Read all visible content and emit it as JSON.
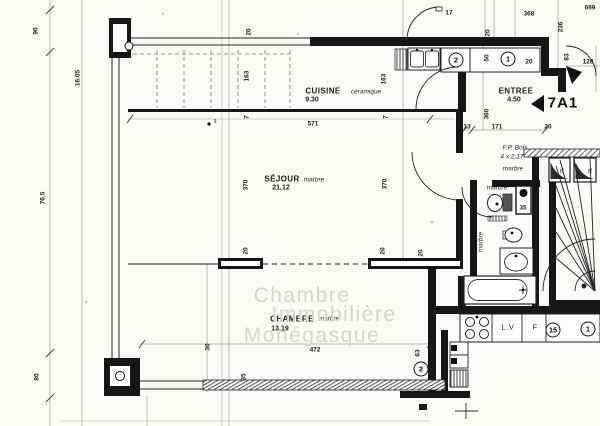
{
  "unit": {
    "label": "7A1"
  },
  "rooms": [
    {
      "name": "CUISINE",
      "area": "9.30",
      "finish": "céramique"
    },
    {
      "name": "ENTREE",
      "area": "4.50",
      "finish": ""
    },
    {
      "name": "SÉJOUR",
      "area": "21.12",
      "finish": "marbre"
    },
    {
      "name": "CHAMBRE",
      "area": "13.19",
      "finish": "marbre"
    },
    {
      "name": "F.P. Bois",
      "area": "4 x 2,17",
      "finish": "marbre"
    }
  ],
  "watermark": [
    "Chambre",
    "Immobilière",
    "Monégasque"
  ],
  "appliances": {
    "dishwasher": "L.V",
    "fridge": "F"
  },
  "colors": {
    "ink": "#1c1c1c",
    "paper": "#fafaf7",
    "watermark": "#d6d6d1"
  },
  "texts": [
    {
      "t": "CUISINE",
      "x": 323,
      "y": 91,
      "cls": "room"
    },
    {
      "t": "9.30",
      "x": 312,
      "y": 100,
      "cls": "area"
    },
    {
      "t": "céramique",
      "x": 366,
      "y": 92,
      "cls": "script"
    },
    {
      "t": "ENTREE",
      "x": 516,
      "y": 91,
      "cls": "room"
    },
    {
      "t": "4.50",
      "x": 514,
      "y": 100,
      "cls": "area"
    },
    {
      "t": "SÉJOUR",
      "x": 282,
      "y": 179,
      "cls": "room"
    },
    {
      "t": "21.12",
      "x": 281,
      "y": 188,
      "cls": "area"
    },
    {
      "t": "marbre",
      "x": 314,
      "y": 180,
      "cls": "script"
    },
    {
      "t": "CHAMBRE",
      "x": 292,
      "y": 319,
      "cls": "room"
    },
    {
      "t": "13.19",
      "x": 280,
      "y": 329,
      "cls": "area"
    },
    {
      "t": "marbre",
      "x": 329,
      "y": 319,
      "cls": "script"
    },
    {
      "t": "F.P. Bois",
      "x": 515,
      "y": 148,
      "cls": "script"
    },
    {
      "t": "4 x 2,17",
      "x": 512,
      "y": 157,
      "cls": "script"
    },
    {
      "t": "marbre",
      "x": 513,
      "y": 169,
      "cls": "script"
    },
    {
      "t": "marbre",
      "x": 497,
      "y": 188,
      "cls": "script"
    },
    {
      "t": "marbre",
      "x": 481,
      "y": 242,
      "cls": "script",
      "rot": 1
    },
    {
      "t": "L.V",
      "x": 508,
      "y": 327,
      "cls": "appliance"
    },
    {
      "t": "F",
      "x": 535,
      "y": 327,
      "cls": "appliance"
    },
    {
      "t": "90",
      "x": 36,
      "y": 31,
      "rot": 1
    },
    {
      "t": "16.05",
      "x": 78,
      "y": 78,
      "rot": 1
    },
    {
      "t": "76.5",
      "x": 43,
      "y": 198,
      "rot": 1
    },
    {
      "t": "80",
      "x": 37,
      "y": 377,
      "rot": 1
    },
    {
      "t": "20",
      "x": 249,
      "y": 32,
      "rot": 1
    },
    {
      "t": "163",
      "x": 247,
      "y": 76,
      "rot": 1
    },
    {
      "t": "7",
      "x": 247,
      "y": 117,
      "rot": 1
    },
    {
      "t": "370",
      "x": 246,
      "y": 185,
      "rot": 1
    },
    {
      "t": "163",
      "x": 384,
      "y": 79,
      "rot": 1
    },
    {
      "t": "7",
      "x": 386,
      "y": 117,
      "rot": 1
    },
    {
      "t": "370",
      "x": 385,
      "y": 184,
      "rot": 1
    },
    {
      "t": "571",
      "x": 313,
      "y": 124
    },
    {
      "t": "17",
      "x": 449,
      "y": 13
    },
    {
      "t": "20",
      "x": 488,
      "y": 33,
      "rot": 1
    },
    {
      "t": "368",
      "x": 529,
      "y": 14
    },
    {
      "t": "699",
      "x": 590,
      "y": 8
    },
    {
      "t": "236",
      "x": 561,
      "y": 27,
      "rot": 1
    },
    {
      "t": "50",
      "x": 487,
      "y": 58,
      "rot": 1
    },
    {
      "t": "20",
      "x": 529,
      "y": 62
    },
    {
      "t": "83",
      "x": 567,
      "y": 57,
      "rot": 1
    },
    {
      "t": "128",
      "x": 588,
      "y": 62
    },
    {
      "t": "360",
      "x": 487,
      "y": 114,
      "rot": 1
    },
    {
      "t": "13",
      "x": 467,
      "y": 127
    },
    {
      "t": "171",
      "x": 497,
      "y": 127
    },
    {
      "t": "20",
      "x": 548,
      "y": 127
    },
    {
      "t": "20",
      "x": 246,
      "y": 251,
      "rot": 1
    },
    {
      "t": "20",
      "x": 383,
      "y": 251,
      "rot": 1
    },
    {
      "t": "20",
      "x": 421,
      "y": 253,
      "rot": 1
    },
    {
      "t": "30",
      "x": 208,
      "y": 347,
      "rot": 1
    },
    {
      "t": "35",
      "x": 244,
      "y": 377,
      "rot": 1
    },
    {
      "t": "472",
      "x": 315,
      "y": 350
    },
    {
      "t": "63",
      "x": 418,
      "y": 353,
      "rot": 1
    },
    {
      "t": "35",
      "x": 523,
      "y": 208
    },
    {
      "t": "75",
      "x": 563,
      "y": 171,
      "cls": "tiny",
      "rot": 1
    },
    {
      "t": "75",
      "x": 591,
      "y": 171,
      "cls": "tiny",
      "rot": 1
    },
    {
      "t": "9",
      "x": 215,
      "y": 122,
      "cls": "tiny"
    },
    {
      "t": "Chambre",
      "x": 302,
      "y": 296,
      "cls": "wm"
    },
    {
      "t": "Immobilière",
      "x": 334,
      "y": 315,
      "cls": "wm"
    },
    {
      "t": "Monégasque",
      "x": 312,
      "y": 336,
      "cls": "wm"
    }
  ],
  "circled_numbers": [
    {
      "n": "2",
      "x": 456,
      "y": 60
    },
    {
      "n": "1",
      "x": 508,
      "y": 59
    },
    {
      "n": "15",
      "x": 553,
      "y": 330
    },
    {
      "n": "1",
      "x": 588,
      "y": 329
    },
    {
      "n": "2",
      "x": 421,
      "y": 369
    }
  ]
}
